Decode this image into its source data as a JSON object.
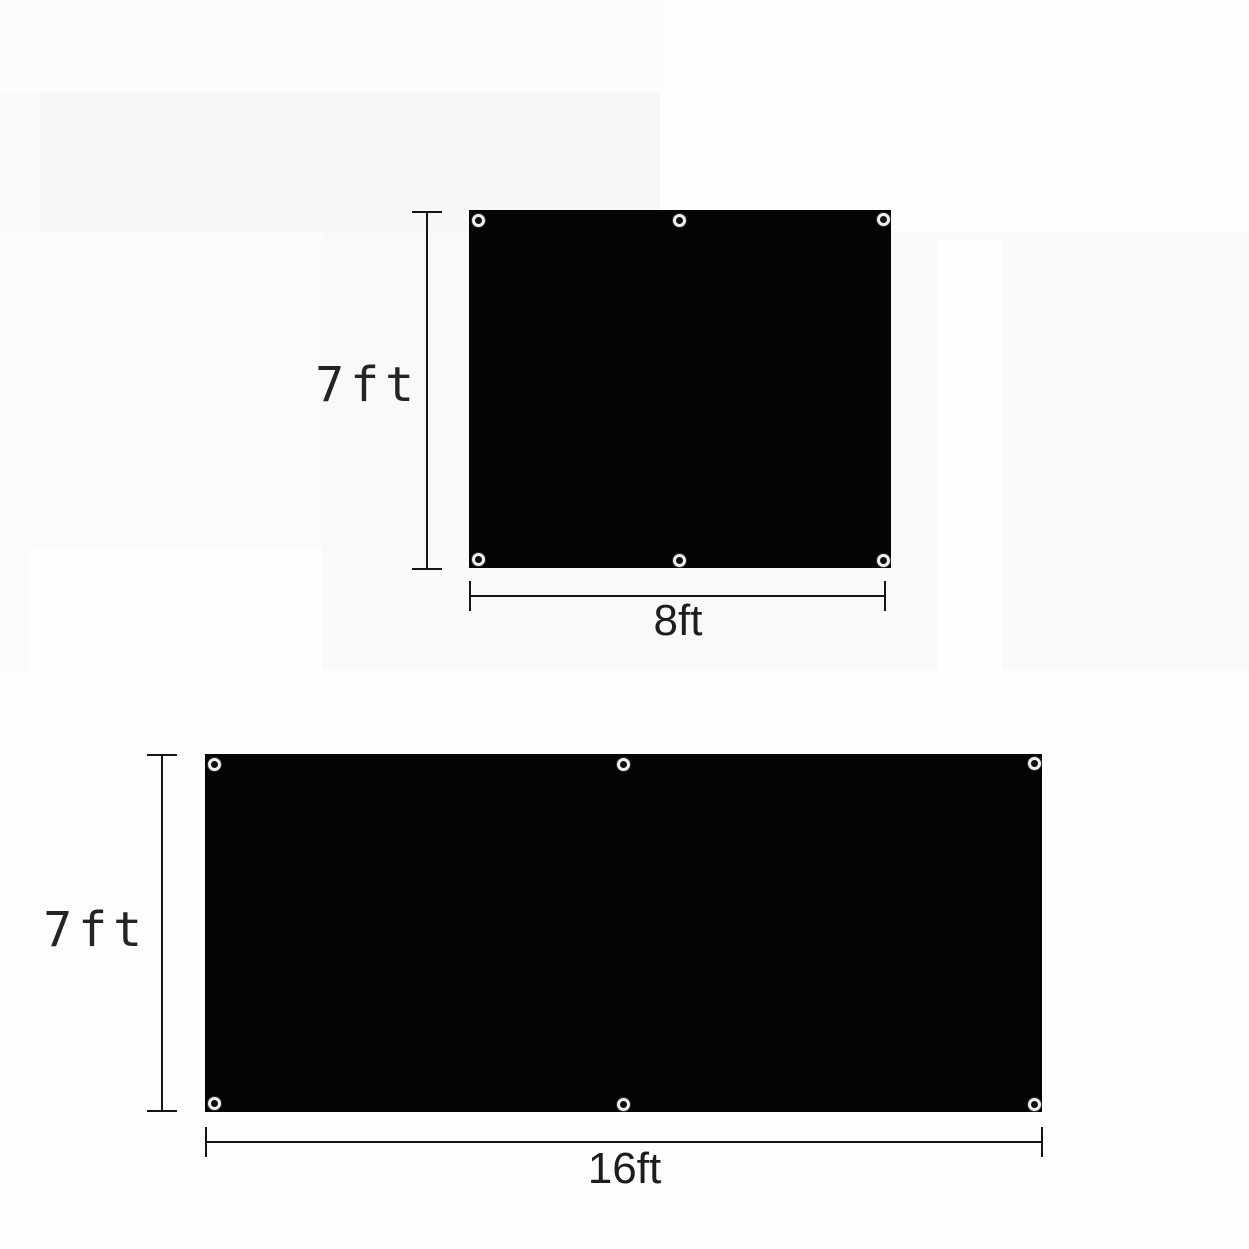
{
  "page": {
    "type": "product-dimension-diagram",
    "background": "#f8f9f9"
  },
  "colors": {
    "fabric": "#040404",
    "dimension_line": "#151515",
    "grommet_ring": "#efefef",
    "grommet_hole": "#101010",
    "height_label_text": "#242424",
    "width_label_text": "#1d1d1d"
  },
  "figures": [
    {
      "name": "panel-8ft-by-7ft",
      "height_label": "7ft",
      "width_label": "8ft",
      "grommet_count": 6
    },
    {
      "name": "panel-16ft-by-7ft",
      "height_label": "7ft",
      "width_label": "16ft",
      "grommet_count": 6
    }
  ]
}
